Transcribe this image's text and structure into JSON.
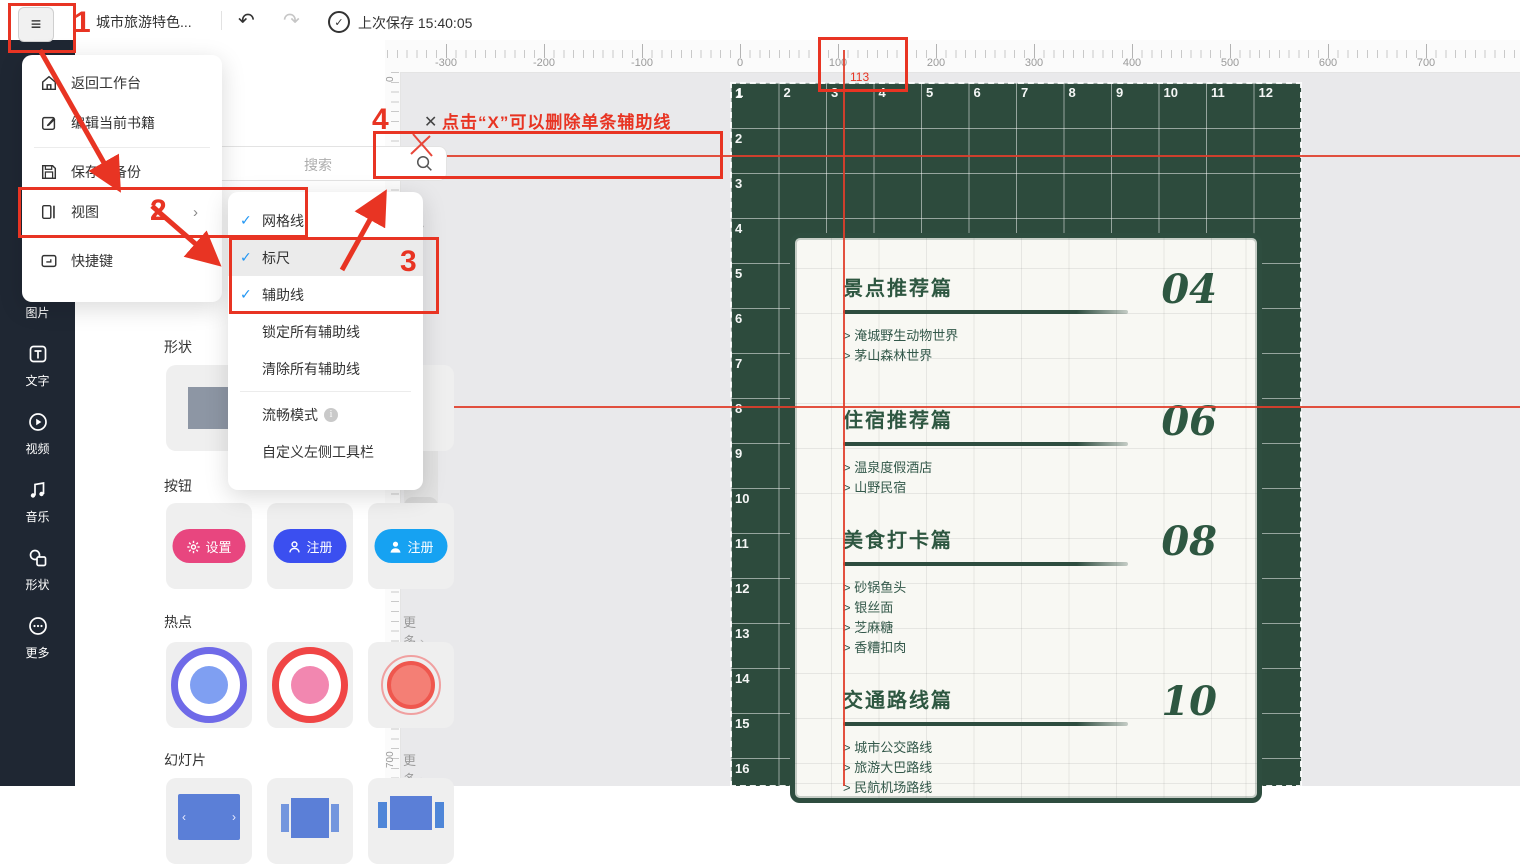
{
  "topbar": {
    "title": "城市旅游特色...",
    "last_saved": "上次保存 15:40:05",
    "check_glyph": "✓"
  },
  "menu": {
    "items": [
      {
        "icon": "home-icon",
        "label": "返回工作台"
      },
      {
        "icon": "edit-icon",
        "label": "编辑当前书籍",
        "divider_after": true
      },
      {
        "icon": "save-icon",
        "label": "保存和备份"
      },
      {
        "icon": "view-icon",
        "label": "视图",
        "chevron": true,
        "divider_after": true
      },
      {
        "icon": "keyboard-icon",
        "label": "快捷键"
      }
    ]
  },
  "submenu": {
    "items": [
      {
        "label": "网格线",
        "checked": true
      },
      {
        "label": "标尺",
        "checked": true,
        "highlighted": true
      },
      {
        "label": "辅助线",
        "checked": true
      },
      {
        "label": "锁定所有辅助线",
        "checked": false
      },
      {
        "label": "清除所有辅助线",
        "checked": false,
        "divider_after": true
      },
      {
        "label": "流畅模式",
        "checked": false,
        "info": true
      },
      {
        "label": "自定义左侧工具栏",
        "checked": false
      }
    ]
  },
  "sidebar": {
    "items": [
      {
        "icon": "image-icon",
        "label": "图片"
      },
      {
        "icon": "text-icon",
        "label": "文字"
      },
      {
        "icon": "video-icon",
        "label": "视频"
      },
      {
        "icon": "music-icon",
        "label": "音乐"
      },
      {
        "icon": "shape-icon",
        "label": "形状"
      },
      {
        "icon": "more-icon",
        "label": "更多"
      }
    ]
  },
  "panel": {
    "search_placeholder": "搜索",
    "more_label": "更多",
    "chevron": "›",
    "sections": {
      "shapes": {
        "label": "形状"
      },
      "buttons": {
        "label": "按钮",
        "buttons": [
          {
            "label": "设置",
            "icon": "gear-icon",
            "color": "#e8467f"
          },
          {
            "label": "注册",
            "icon": "person-outline-icon",
            "color": "#3b4ff0"
          },
          {
            "label": "注册",
            "icon": "person-icon",
            "color": "#16a2f2"
          }
        ]
      },
      "hotspots": {
        "label": "热点"
      },
      "slides": {
        "label": "幻灯片"
      }
    }
  },
  "canvas": {
    "h_ruler_labels": [
      -300,
      -200,
      -100,
      0,
      100,
      200,
      300,
      400,
      500,
      600,
      700
    ],
    "v_ruler_labels": [
      0,
      100,
      200,
      300,
      400,
      500,
      600,
      700
    ],
    "guides": {
      "h1_pos": "76",
      "v1_pos": "113"
    },
    "collapse_glyph": "|<"
  },
  "poster": {
    "title": "目录",
    "subtitle": "CONTENTS",
    "grid_columns": [
      1,
      2,
      3,
      4,
      5,
      6,
      7,
      8,
      9,
      10,
      11,
      12
    ],
    "grid_rows": [
      1,
      2,
      3,
      4,
      5,
      6,
      7,
      8,
      9,
      10,
      11,
      12,
      13,
      14,
      15,
      16
    ],
    "item_prefix": "> ",
    "toc": [
      {
        "title": "景点推荐篇",
        "page": "04",
        "items": [
          "淹城野生动物世界",
          "茅山森林世界"
        ]
      },
      {
        "title": "住宿推荐篇",
        "page": "06",
        "items": [
          "温泉度假酒店",
          "山野民宿"
        ]
      },
      {
        "title": "美食打卡篇",
        "page": "08",
        "items": [
          "砂锅鱼头",
          "银丝面",
          "芝麻糖",
          "香糟扣肉"
        ]
      },
      {
        "title": "交通路线篇",
        "page": "10",
        "items": [
          "城市公交路线",
          "旅游大巴路线",
          "民航机场路线"
        ]
      }
    ],
    "colors": {
      "background": "#2d4b3d",
      "accent": "#2e5741",
      "card": "#f8f8f3"
    }
  },
  "annotations": {
    "steps": [
      "1",
      "2",
      "3",
      "4"
    ],
    "tip": "点击“X”可以删除单条辅助线",
    "accent": "#e83423"
  }
}
